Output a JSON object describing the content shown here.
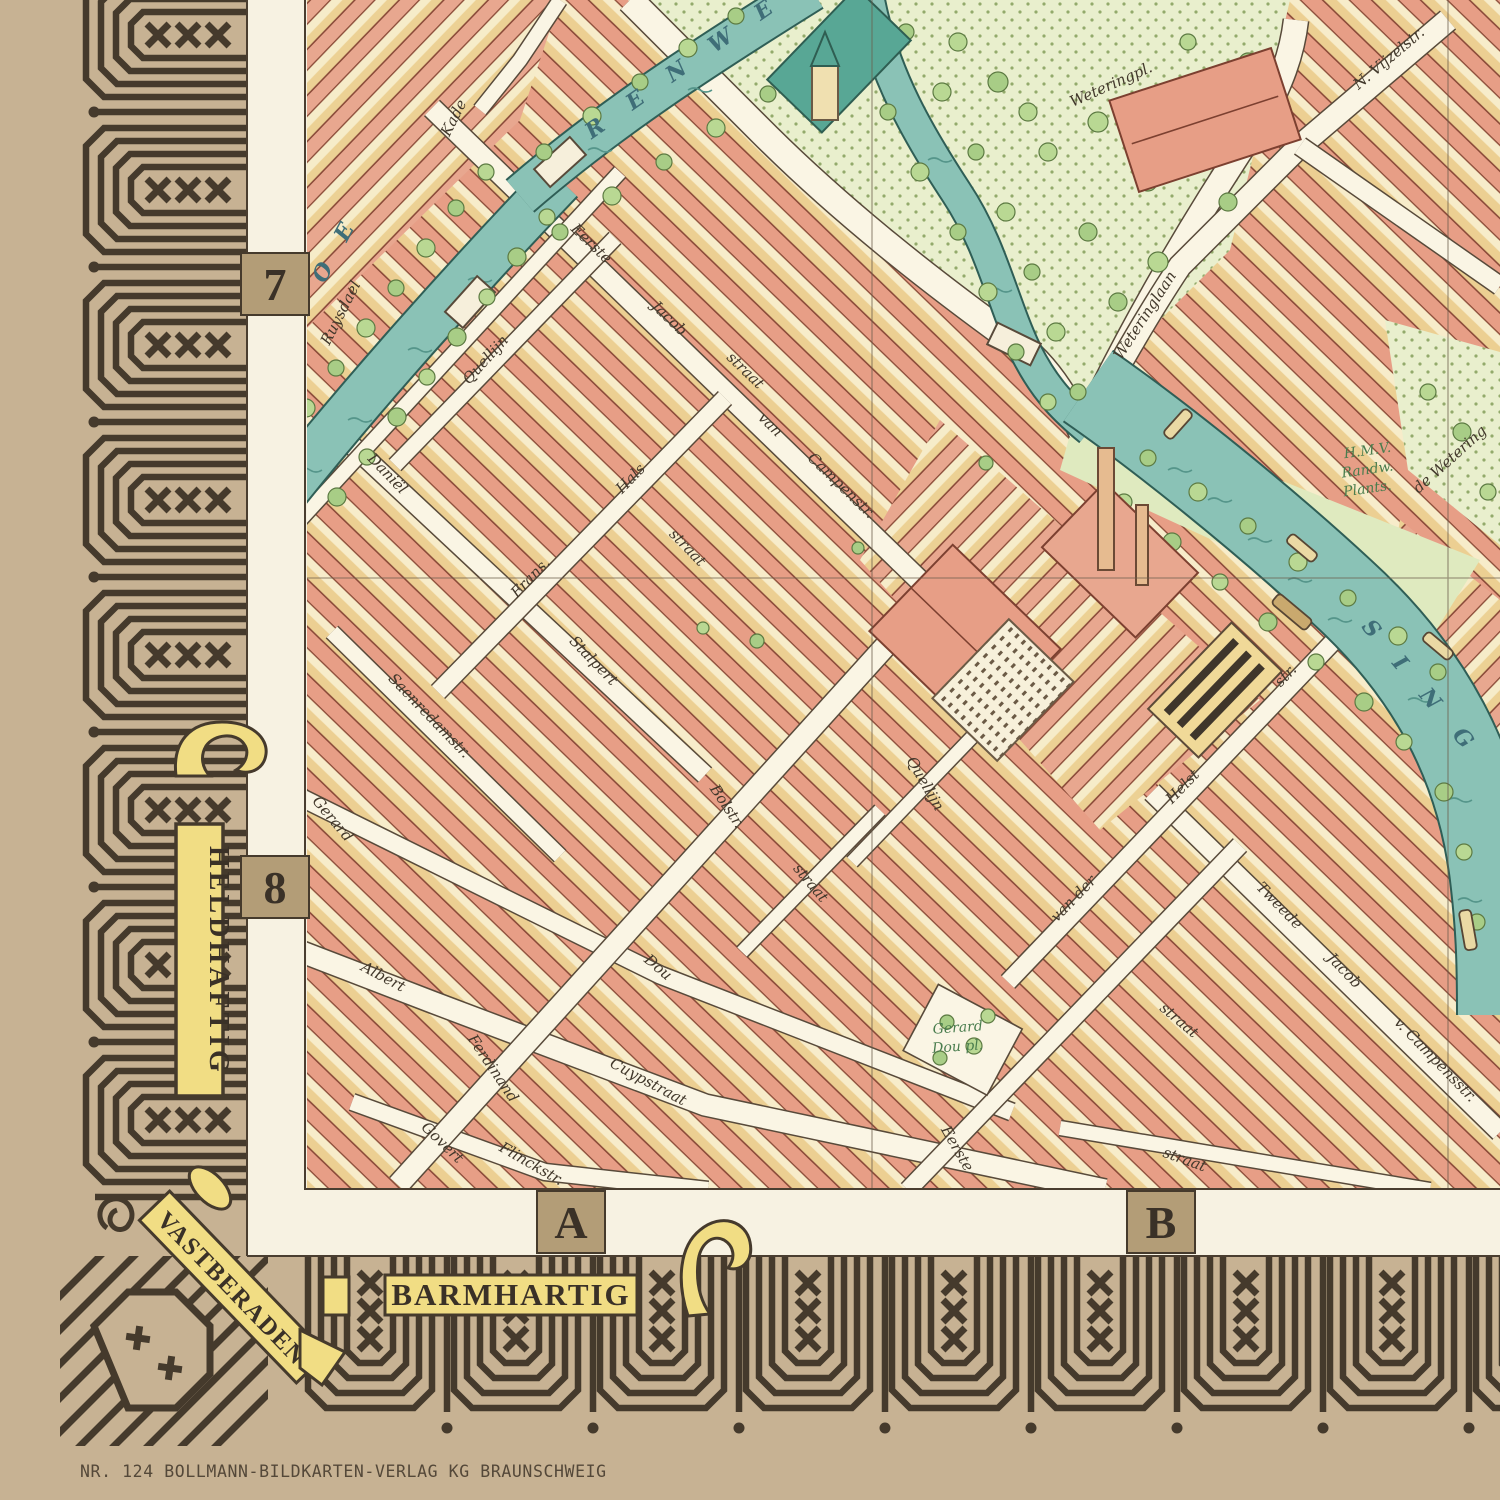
{
  "colors": {
    "paper_tan": "#c7b293",
    "border_ink": "#453a2c",
    "ribbon_yellow": "#f1dd84",
    "map_paper": "#f9f3e0",
    "roof_salmon": "#e79e86",
    "wall_yellow": "#efd28f",
    "canal_teal": "#8ac2b6",
    "tree_green": "#b9d893",
    "street_white": "#faf5e4",
    "label_ink": "#42382b",
    "canal_label_ink": "#3f6e78",
    "park_label_green": "#4a7d4e"
  },
  "border": {
    "banner_left": "HELDHAFTIG",
    "banner_corner": "VASTBERADEN",
    "banner_bottom": "BARMHARTIG",
    "grid_labels": {
      "row_top": "7",
      "row_bottom": "8",
      "col_left": "A",
      "col_right": "B"
    }
  },
  "imprint": "NR. 124 BOLLMANN-BILDKARTEN-VERLAG KG BRAUNSCHWEIG",
  "map": {
    "street_labels": [
      {
        "text": "Ruysdael",
        "x": 345,
        "y": 315,
        "r": -63,
        "s": 15
      },
      {
        "text": "Kade",
        "x": 458,
        "y": 120,
        "r": -63,
        "s": 15
      },
      {
        "text": "Quellijn",
        "x": 489,
        "y": 363,
        "r": -48,
        "s": 15
      },
      {
        "text": "Daniël",
        "x": 384,
        "y": 477,
        "r": 46,
        "s": 15
      },
      {
        "text": "Stalpert",
        "x": 590,
        "y": 664,
        "r": 46,
        "s": 15
      },
      {
        "text": "Frans.",
        "x": 534,
        "y": 581,
        "r": -46,
        "s": 15
      },
      {
        "text": "Hals",
        "x": 634,
        "y": 482,
        "r": -46,
        "s": 15
      },
      {
        "text": "straat",
        "x": 684,
        "y": 551,
        "r": 46,
        "s": 15
      },
      {
        "text": "Eerste",
        "x": 588,
        "y": 247,
        "r": 44,
        "s": 15
      },
      {
        "text": "Jacob",
        "x": 666,
        "y": 322,
        "r": 44,
        "s": 15
      },
      {
        "text": "straat",
        "x": 742,
        "y": 374,
        "r": 44,
        "s": 15
      },
      {
        "text": "van",
        "x": 767,
        "y": 428,
        "r": 44,
        "s": 15
      },
      {
        "text": "Campenstr.",
        "x": 838,
        "y": 489,
        "r": 44,
        "s": 15
      },
      {
        "text": "Saenredamstr.",
        "x": 426,
        "y": 719,
        "r": 46,
        "s": 13
      },
      {
        "text": "Gerard",
        "x": 329,
        "y": 822,
        "r": 50,
        "s": 15
      },
      {
        "text": "Dou",
        "x": 655,
        "y": 971,
        "r": 40,
        "s": 15
      },
      {
        "text": "Albert",
        "x": 381,
        "y": 981,
        "r": 28,
        "s": 15
      },
      {
        "text": "Cuypstraat",
        "x": 646,
        "y": 1086,
        "r": 28,
        "s": 15
      },
      {
        "text": "Govert",
        "x": 439,
        "y": 1146,
        "r": 44,
        "s": 15
      },
      {
        "text": "Flinckstr.",
        "x": 529,
        "y": 1168,
        "r": 30,
        "s": 15
      },
      {
        "text": "Ferdinand",
        "x": 489,
        "y": 1071,
        "r": 56,
        "s": 15
      },
      {
        "text": "Bolstr.",
        "x": 723,
        "y": 809,
        "r": 56,
        "s": 15
      },
      {
        "text": "straat",
        "x": 807,
        "y": 886,
        "r": 50,
        "s": 15
      },
      {
        "text": "Quellijn",
        "x": 921,
        "y": 786,
        "r": 60,
        "s": 13
      },
      {
        "text": "van der",
        "x": 1077,
        "y": 902,
        "r": -46,
        "s": 15
      },
      {
        "text": "Helst",
        "x": 1186,
        "y": 790,
        "r": -46,
        "s": 15
      },
      {
        "text": "str.",
        "x": 1289,
        "y": 679,
        "r": -46,
        "s": 15
      },
      {
        "text": "Tweede",
        "x": 1276,
        "y": 909,
        "r": 46,
        "s": 15
      },
      {
        "text": "Jacob",
        "x": 1341,
        "y": 974,
        "r": 46,
        "s": 15
      },
      {
        "text": "v. Campensstr.",
        "x": 1432,
        "y": 1063,
        "r": 46,
        "s": 15
      },
      {
        "text": "Eerste",
        "x": 953,
        "y": 1151,
        "r": 60,
        "s": 15
      },
      {
        "text": "straat",
        "x": 1176,
        "y": 1024,
        "r": 40,
        "s": 15
      },
      {
        "text": "straat",
        "x": 1183,
        "y": 1164,
        "r": 20,
        "s": 15
      },
      {
        "text": "Weteringlaan",
        "x": 1149,
        "y": 318,
        "r": -57,
        "s": 16
      },
      {
        "text": "Weteringpl.",
        "x": 1113,
        "y": 89,
        "r": -24,
        "s": 15
      },
      {
        "text": "N. Vijzelstr.",
        "x": 1392,
        "y": 62,
        "r": -40,
        "s": 16
      },
      {
        "text": "de Wetering",
        "x": 1453,
        "y": 463,
        "r": -42,
        "s": 13
      }
    ],
    "canal_labels": [
      {
        "text": "B O E",
        "x": 331,
        "y": 272,
        "r": -62,
        "s": 22,
        "ls": 10
      },
      {
        "text": "R E N W E",
        "x": 688,
        "y": 72,
        "r": -35,
        "s": 22,
        "ls": 12
      },
      {
        "text": "S I N G",
        "x": 1416,
        "y": 693,
        "r": 50,
        "s": 22,
        "ls": 12
      }
    ],
    "place_labels": [
      {
        "lines": [
          "H.M.V.",
          "Randw.",
          "Plants."
        ],
        "x": 1368,
        "y": 455,
        "r": -8
      },
      {
        "lines": [
          "Gerard",
          "Dou pl."
        ],
        "x": 958,
        "y": 1032,
        "r": -4
      }
    ]
  }
}
